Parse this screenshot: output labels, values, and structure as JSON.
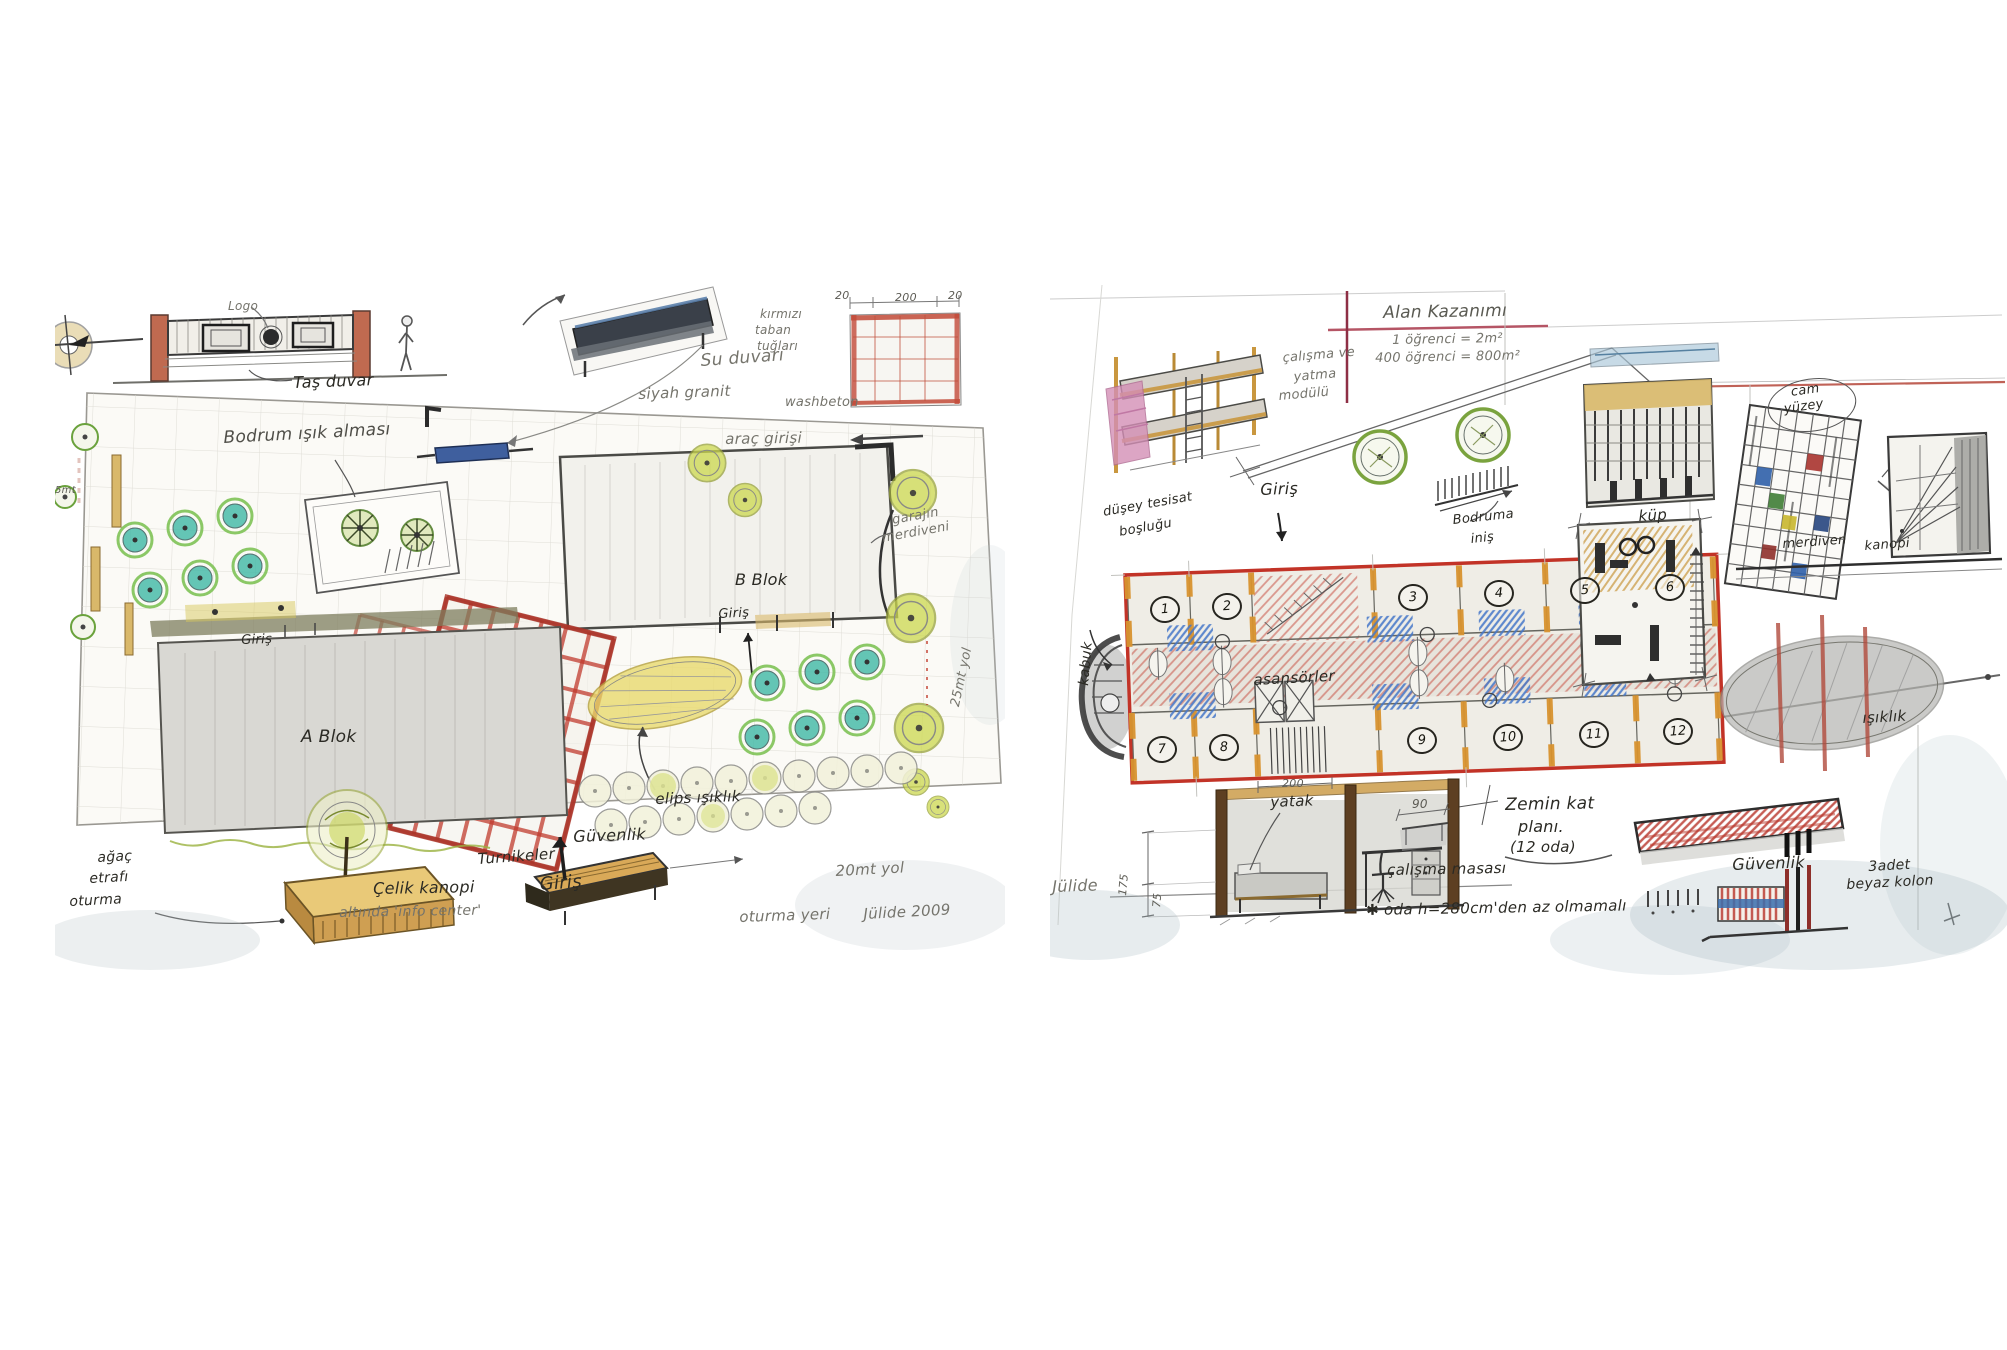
{
  "palette": {
    "pencil": "#8a8a86",
    "ink": "#2b2a24",
    "red_crayon": "#c0392b",
    "crimson_line": "#8e2f45",
    "orange_wall": "#d8932f",
    "tan_wood": "#d3a455",
    "teal_tree": "#3fb8a6",
    "leaf_green": "#7ec256",
    "yellow_green": "#ccd84e",
    "skylight_yellow": "#e8d96b",
    "water_blue": "#3c5fa0",
    "furniture_blue": "#4477c9",
    "pink_mattress": "#d48fb6",
    "wash_gray": "#aebfc6"
  },
  "left": {
    "logo": "Logo",
    "tas_duvar": "Taş duvar",
    "bodrum_isik": "Bodrum ışık alması",
    "su_duvari": "Su duvarı",
    "siyah_granit": "siyah granit",
    "kirmizi_1": "kırmızı",
    "kirmizi_2": "taban",
    "kirmizi_3": "tuğları",
    "washbeton": "washbeton",
    "dim_20a": "20",
    "dim_200": "200",
    "dim_20b": "20",
    "arac_girisi": "araç girişi",
    "garaj_1": "garajın",
    "garaj_2": "merdiveni",
    "b_blok": "B Blok",
    "b_giris": "Giriş",
    "yol_25": "25mt yol",
    "a_giris": "Giriş",
    "a_blok": "A Blok",
    "elips": "elips ışıklık",
    "guvenlik": "Güvenlik",
    "turnikeler": "Turnikeler",
    "giris_main": "Giriş",
    "kanopi_1": "Çelik kanopi",
    "kanopi_2": "altında 'info center'",
    "agac_1": "ağaç",
    "agac_2": "etrafı",
    "agac_3": "oturma",
    "oturma_yeri": "oturma yeri",
    "yol_20": "20mt yol",
    "signature": "Jülide 2009",
    "dim_5": "5mt"
  },
  "right": {
    "title": "Alan Kazanımı",
    "calc1": "1 öğrenci = 2m²",
    "calc2": "400 öğrenci = 800m²",
    "modul_1": "çalışma ve",
    "modul_2": "yatma",
    "modul_3": "modülü",
    "giris": "Giriş",
    "tesisat_1": "düşey tesisat",
    "tesisat_2": "boşluğu",
    "kabuk": "kabuk",
    "bodruma_1": "Bodruma",
    "bodruma_2": "iniş",
    "kup": "küp",
    "cam_1": "cam",
    "cam_2": "yüzey",
    "merdiven": "merdiven",
    "kanopi": "kanopi",
    "rooms": [
      "1",
      "2",
      "3",
      "4",
      "5",
      "6",
      "7",
      "8",
      "9",
      "10",
      "11",
      "12"
    ],
    "asansorler": "asansörler",
    "dim_200": "200",
    "yatak": "yatak",
    "dim_90": "90",
    "zemin_1": "Zemin kat",
    "zemin_2": "planı.",
    "zemin_3": "(12 oda)",
    "calisma_masasi": "çalışma masası",
    "oda_note": "✱ oda h=280cm'den az olmamalı",
    "dim_175": "175",
    "dim_75": "75",
    "guvenlik": "Güvenlik",
    "kolon_1": "3adet",
    "kolon_2": "beyaz kolon",
    "isiklik": "ışıklık",
    "signature": "Jülide"
  }
}
